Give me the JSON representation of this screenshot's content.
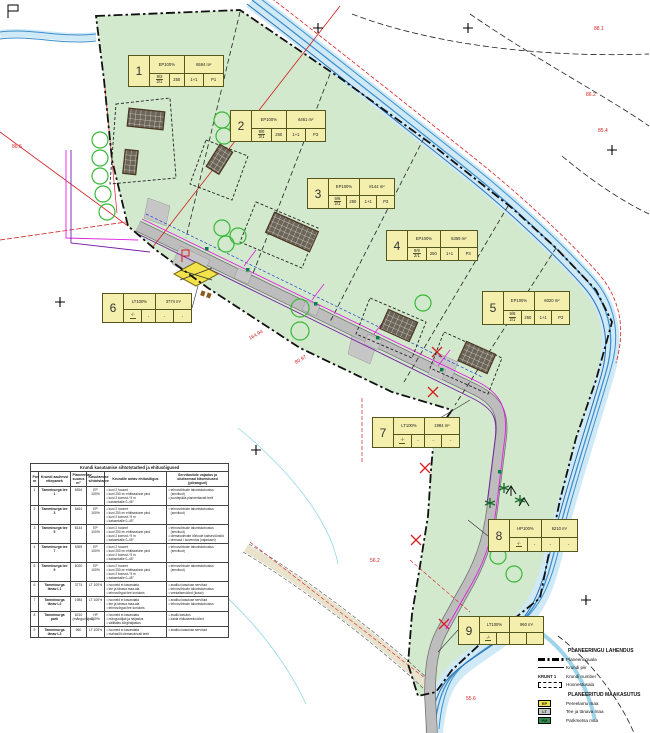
{
  "plots": [
    {
      "num": "1",
      "use": "EP100%",
      "area": "6594 m²",
      "frac_top": "9/3",
      "frac_bot": "2/1",
      "c1": "250",
      "c2": "1+1",
      "c3": "P1"
    },
    {
      "num": "2",
      "use": "EP100%",
      "area": "6461 m²",
      "frac_top": "9/0",
      "frac_bot": "2/1",
      "c1": "250",
      "c2": "1+1",
      "c3": "P3"
    },
    {
      "num": "3",
      "use": "EP100%",
      "area": "8144 m²",
      "frac_top": "9/6",
      "frac_bot": "2/1",
      "c1": "250",
      "c2": "1+1",
      "c3": "P3"
    },
    {
      "num": "4",
      "use": "EP100%",
      "area": "5359 m²",
      "frac_top": "9/9",
      "frac_bot": "2/1",
      "c1": "250",
      "c2": "1+1",
      "c3": "P3"
    },
    {
      "num": "5",
      "use": "EP100%",
      "area": "6020 m²",
      "frac_top": "9/6",
      "frac_bot": "2/1",
      "c1": "250",
      "c2": "1+1",
      "c3": "P3"
    },
    {
      "num": "6",
      "use": "LT100%",
      "area": "3774 m²",
      "frac_top": "-/-",
      "frac_bot": "",
      "c1": "-",
      "c2": "-",
      "c3": "-"
    },
    {
      "num": "7",
      "use": "LT100%",
      "area": "1984 m²",
      "frac_top": "-/-",
      "frac_bot": "",
      "c1": "-",
      "c2": "-",
      "c3": "-"
    },
    {
      "num": "8",
      "use": "HP100%",
      "area": "6210 m²",
      "frac_top": "-/-",
      "frac_bot": "",
      "c1": "-",
      "c2": "-",
      "c3": "-"
    },
    {
      "num": "9",
      "use": "LT100%",
      "area": "960 m²",
      "frac_top": "-/-",
      "frac_bot": "",
      "c1": "",
      "c2": "",
      "c3": ""
    }
  ],
  "table": {
    "title": "Krundi kasutamise sihtotstarbed ja ehitusõigused",
    "headers": [
      "Pos nr",
      "Krundi aadressi ettepanek",
      "Planeeritav suurus m²",
      "Kasutamise sihtotstarve",
      "Krundile antav ehitusõigus",
      "Servituutide vajadus ja olulisemad kitsendused (piirangud)"
    ],
    "rows": [
      {
        "pos": "1",
        "name": "Tamminurga tee 1",
        "size": "6594",
        "use": "EP 100%",
        "rights": [
          "kuni 2 hoonet",
          "kuni 250 m² ehitisealune pind",
          "kuni 2 korrust / 9 m",
          "katusekalle 0–45°"
        ],
        "restrictions": [
          "tehnovõrkude talumiskohustus (servituut)",
          "juurdepääs planeeritavalt teelt"
        ]
      },
      {
        "pos": "2",
        "name": "Tamminurga tee 3",
        "size": "6461",
        "use": "EP 100%",
        "rights": [
          "kuni 2 hoonet",
          "kuni 250 m² ehitisealune pind",
          "kuni 2 korrust / 9 m",
          "katusekalle 0–45°"
        ],
        "restrictions": [
          "tehnovõrkude talumiskohustus (servituut)"
        ]
      },
      {
        "pos": "3",
        "name": "Tamminurga tee 5",
        "size": "8144",
        "use": "EP 100%",
        "rights": [
          "kuni 2 hoonet",
          "kuni 250 m² ehitisealune pind",
          "kuni 2 korrust / 9 m",
          "katusekalle 0–45°"
        ],
        "restrictions": [
          "tehnovõrkude talumiskohustus (servituut)",
          "olemasolevate võrkude kaitsevööndid",
          "drenaaž / kuivendus (vajadusel)"
        ]
      },
      {
        "pos": "4",
        "name": "Tamminurga tee 7",
        "size": "5359",
        "use": "EP 100%",
        "rights": [
          "kuni 2 hoonet",
          "kuni 250 m² ehitisealune pind",
          "kuni 2 korrust / 9 m",
          "katusekalle 0–45°"
        ],
        "restrictions": [
          "tehnovõrkude talumiskohustus (servituut)"
        ]
      },
      {
        "pos": "5",
        "name": "Tamminurga tee 9",
        "size": "6020",
        "use": "EP 100%",
        "rights": [
          "kuni 2 hoonet",
          "kuni 250 m² ehitisealune pind",
          "kuni 2 korrust / 9 m",
          "katusekalle 0–45°"
        ],
        "restrictions": [
          "tehnovõrkude talumiskohustus (servituut)"
        ]
      },
      {
        "pos": "6",
        "name": "Tamminurga tänav L1",
        "size": "3774",
        "use": "LT 100%",
        "rights": [
          "hooneid ei kavandata",
          "tee ja tänava maa-ala",
          "tehnovõrgud tee koridoris"
        ],
        "restrictions": [
          "avaliku kasutuse servituut",
          "tehnovõrkude talumiskohustus",
          "veekaitsevöönd (kraav)"
        ]
      },
      {
        "pos": "7",
        "name": "Tamminurga tänav L2",
        "size": "1984",
        "use": "LT 100%",
        "rights": [
          "hooneid ei kavandata",
          "tee ja tänava maa-ala",
          "tehnovõrgud tee koridoris"
        ],
        "restrictions": [
          "avaliku kasutuse servituut",
          "tehnovõrkude talumiskohustus"
        ]
      },
      {
        "pos": "8",
        "name": "Tamminurga park",
        "size": "6210 (mänguväljak)",
        "use": "HP 100%",
        "rights": [
          "hooneid ei kavandata",
          "mänguväljak ja haljastus",
          "säilitatav kõrghaljastus"
        ],
        "restrictions": [
          "avalik kasutus",
          "kalda ehituskeeluvöönd"
        ]
      },
      {
        "pos": "9",
        "name": "Tamminurga tänav L3",
        "size": "960",
        "use": "LT 100%",
        "rights": [
          "hooneid ei kavandata",
          "mahasõit olemasolevalt teelt"
        ],
        "restrictions": [
          "avaliku kasutuse servituut"
        ]
      }
    ]
  },
  "legend": {
    "section1_title": "PLANEERINGU LAHENDUS",
    "solution_items": [
      {
        "symbol": "dashdot",
        "symbol_text": "",
        "label": "Planeeringuala"
      },
      {
        "symbol": "line",
        "symbol_text": "",
        "label": "Krundi piir"
      },
      {
        "symbol": "krunt",
        "symbol_text": "KRUNT 1",
        "label": "Krundi number"
      },
      {
        "symbol": "dashedrect",
        "symbol_text": "",
        "label": "Hoonestusala"
      }
    ],
    "section2_title": "PLANEERITUD MAAKASUTUS",
    "landuse_items": [
      {
        "code": "EP",
        "color": "#f0e24a",
        "label": "Pereelamu maa"
      },
      {
        "code": "LT",
        "color": "#c8c8c8",
        "label": "Tee ja tänava maa"
      },
      {
        "code": "PM",
        "color": "#2f9150",
        "label": "Parkmetsa maa"
      }
    ]
  },
  "map": {
    "red_labels": [
      "164.94",
      "80.97",
      "88.1",
      "86.2",
      "85.4",
      "86.6",
      "56.2",
      "55.6"
    ],
    "colors": {
      "green_area": "#d2e9cd",
      "river": "#cfeaf6",
      "river_line": "#3f8fcc",
      "road": "#bdbdbd",
      "label_bg": "#f5efad",
      "red": "#d42020",
      "magenta": "#e020e0",
      "purple": "#7a1fa8",
      "tree": "#38b838",
      "boundary": "#111111"
    }
  }
}
